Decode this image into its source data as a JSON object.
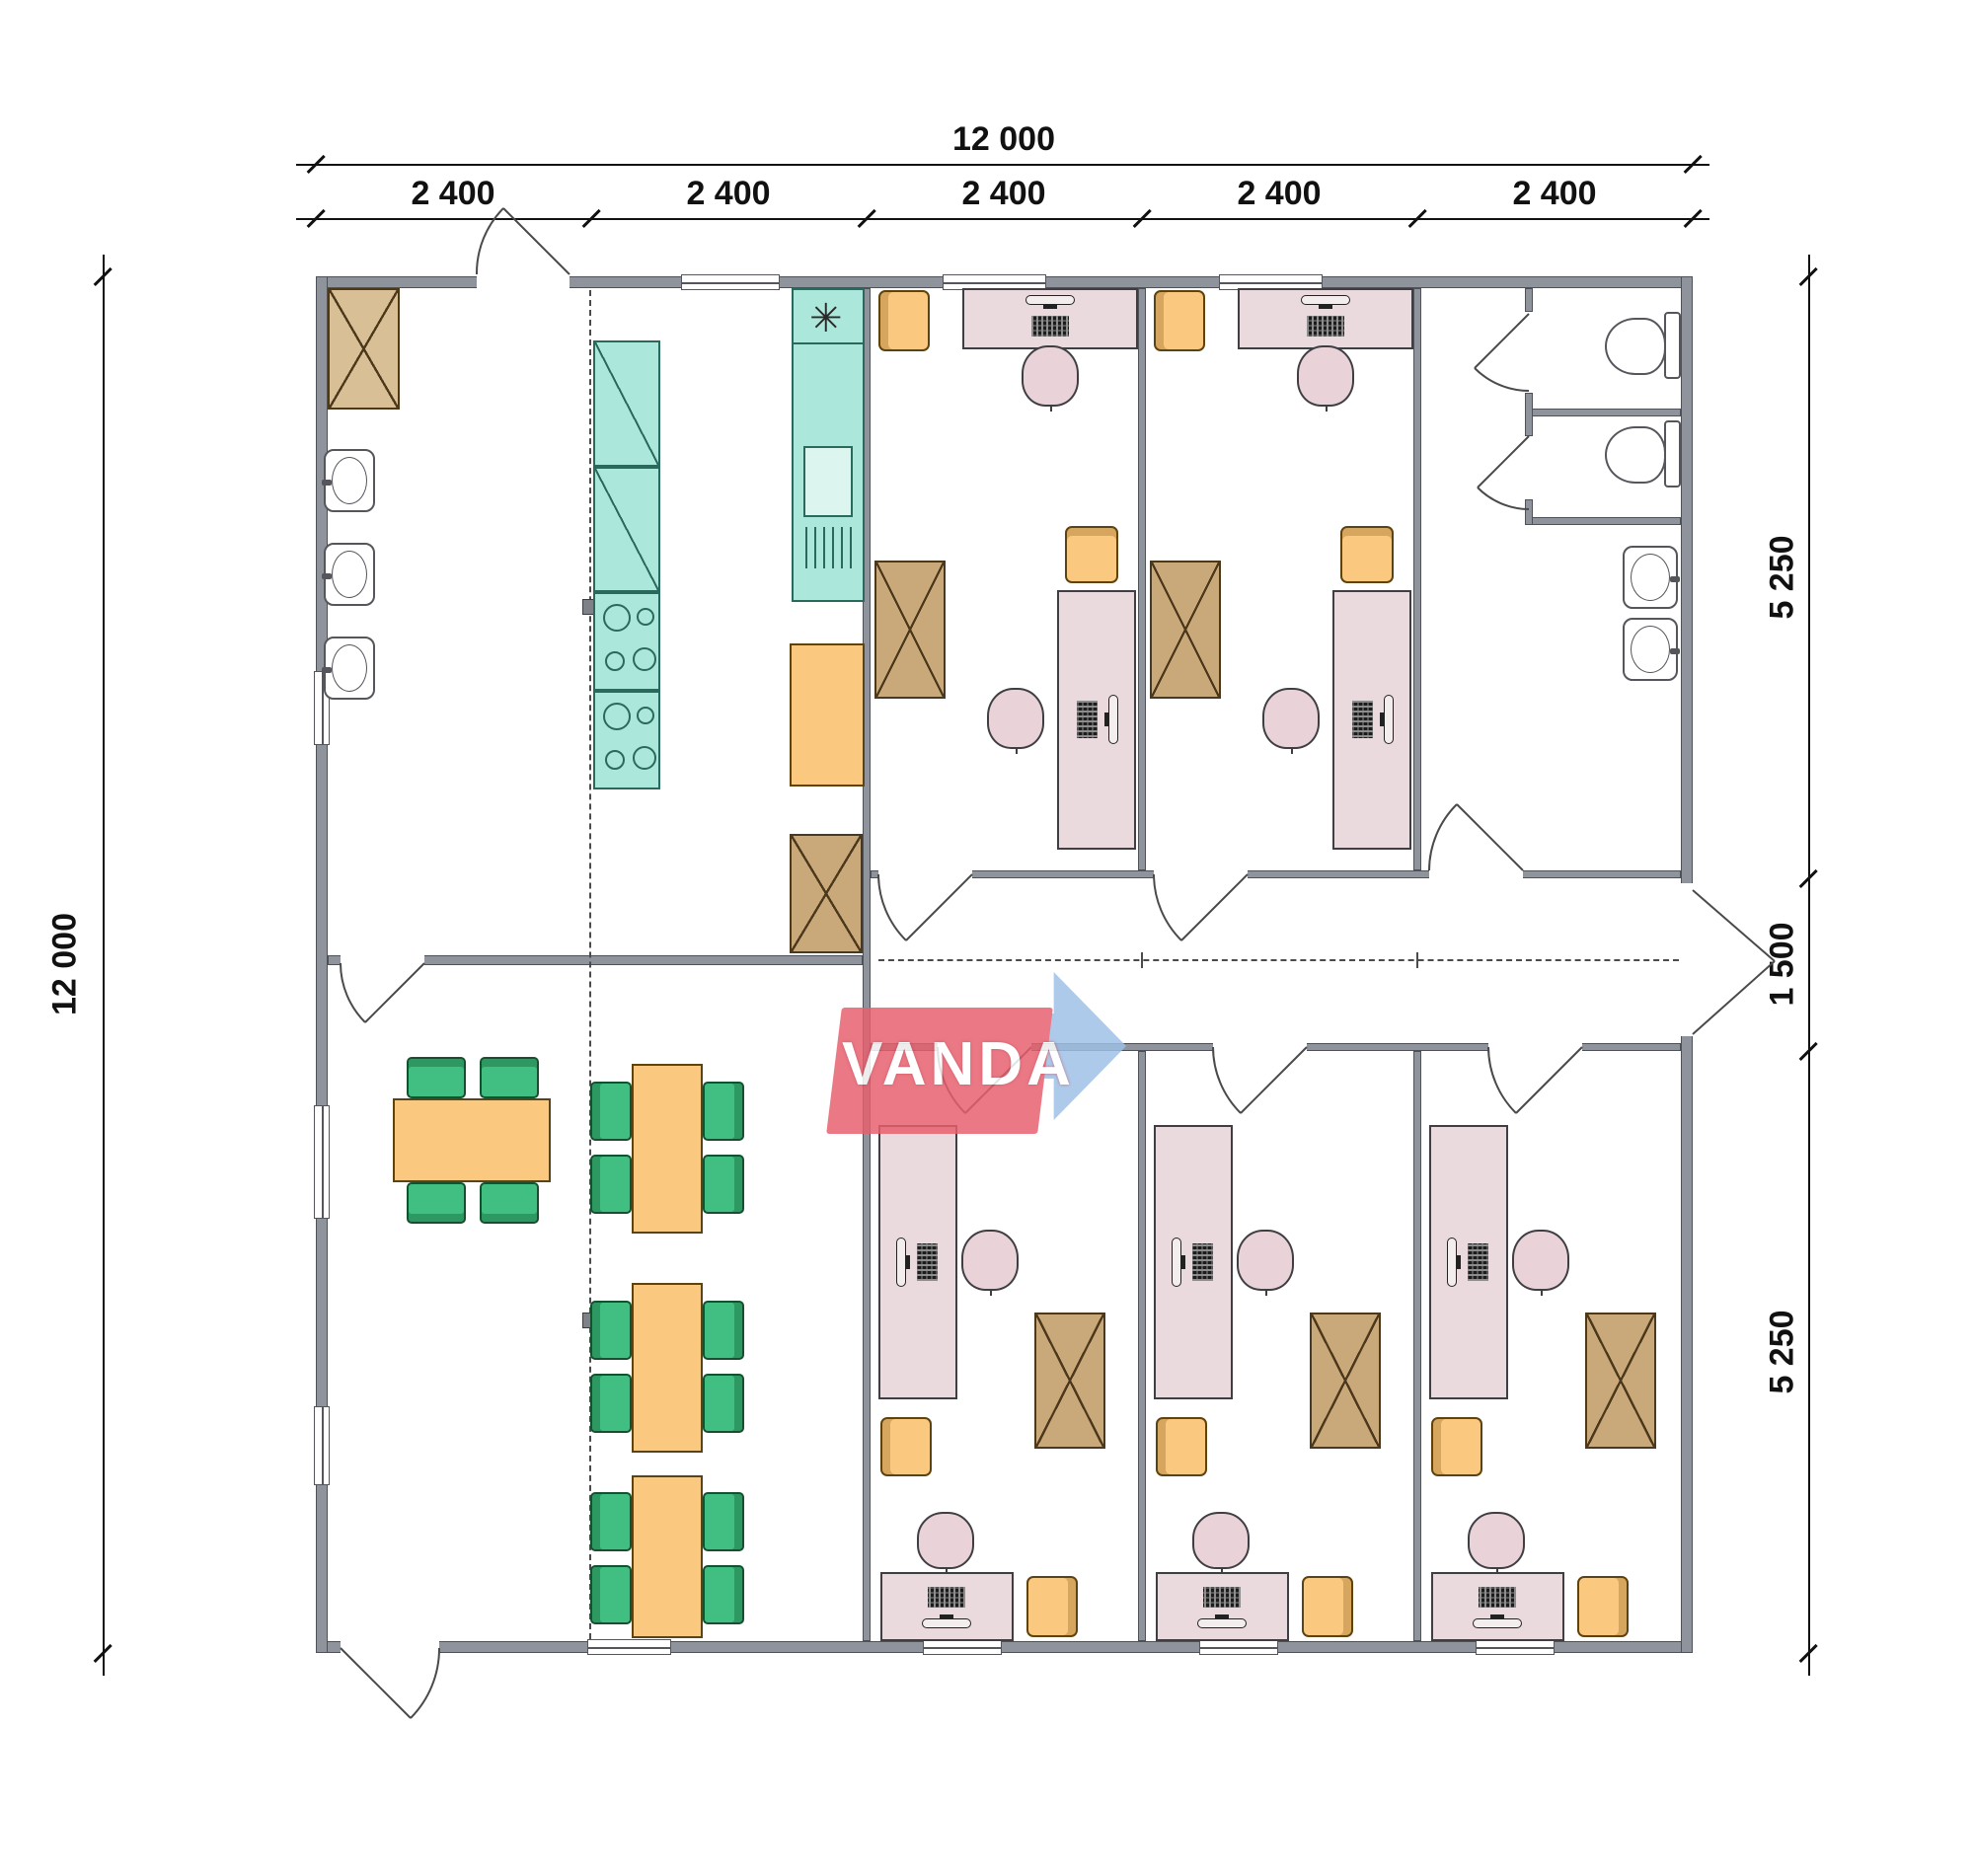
{
  "watermark": {
    "text": "VANDA",
    "red": "#e8606e",
    "blue": "#9fc0e6"
  },
  "dimensions": {
    "top_total": "12 000",
    "top_modules": [
      "2 400",
      "2 400",
      "2 400",
      "2 400",
      "2 400"
    ],
    "left_total": "12 000",
    "right_top": "5 250",
    "right_middle": "1 500",
    "right_bottom": "5 250"
  },
  "symbols": {
    "kitchen_vent": "✳"
  },
  "colors": {
    "wall": "#8f939b",
    "desk_pink": "#ead9dd",
    "chair_orange": "#fbc87f",
    "cabinet_tan": "#c9a97a",
    "kitchen_teal": "#ace7db",
    "dining_green": "#41bf82",
    "table_orange": "#fbc87f",
    "line": "#111111"
  }
}
